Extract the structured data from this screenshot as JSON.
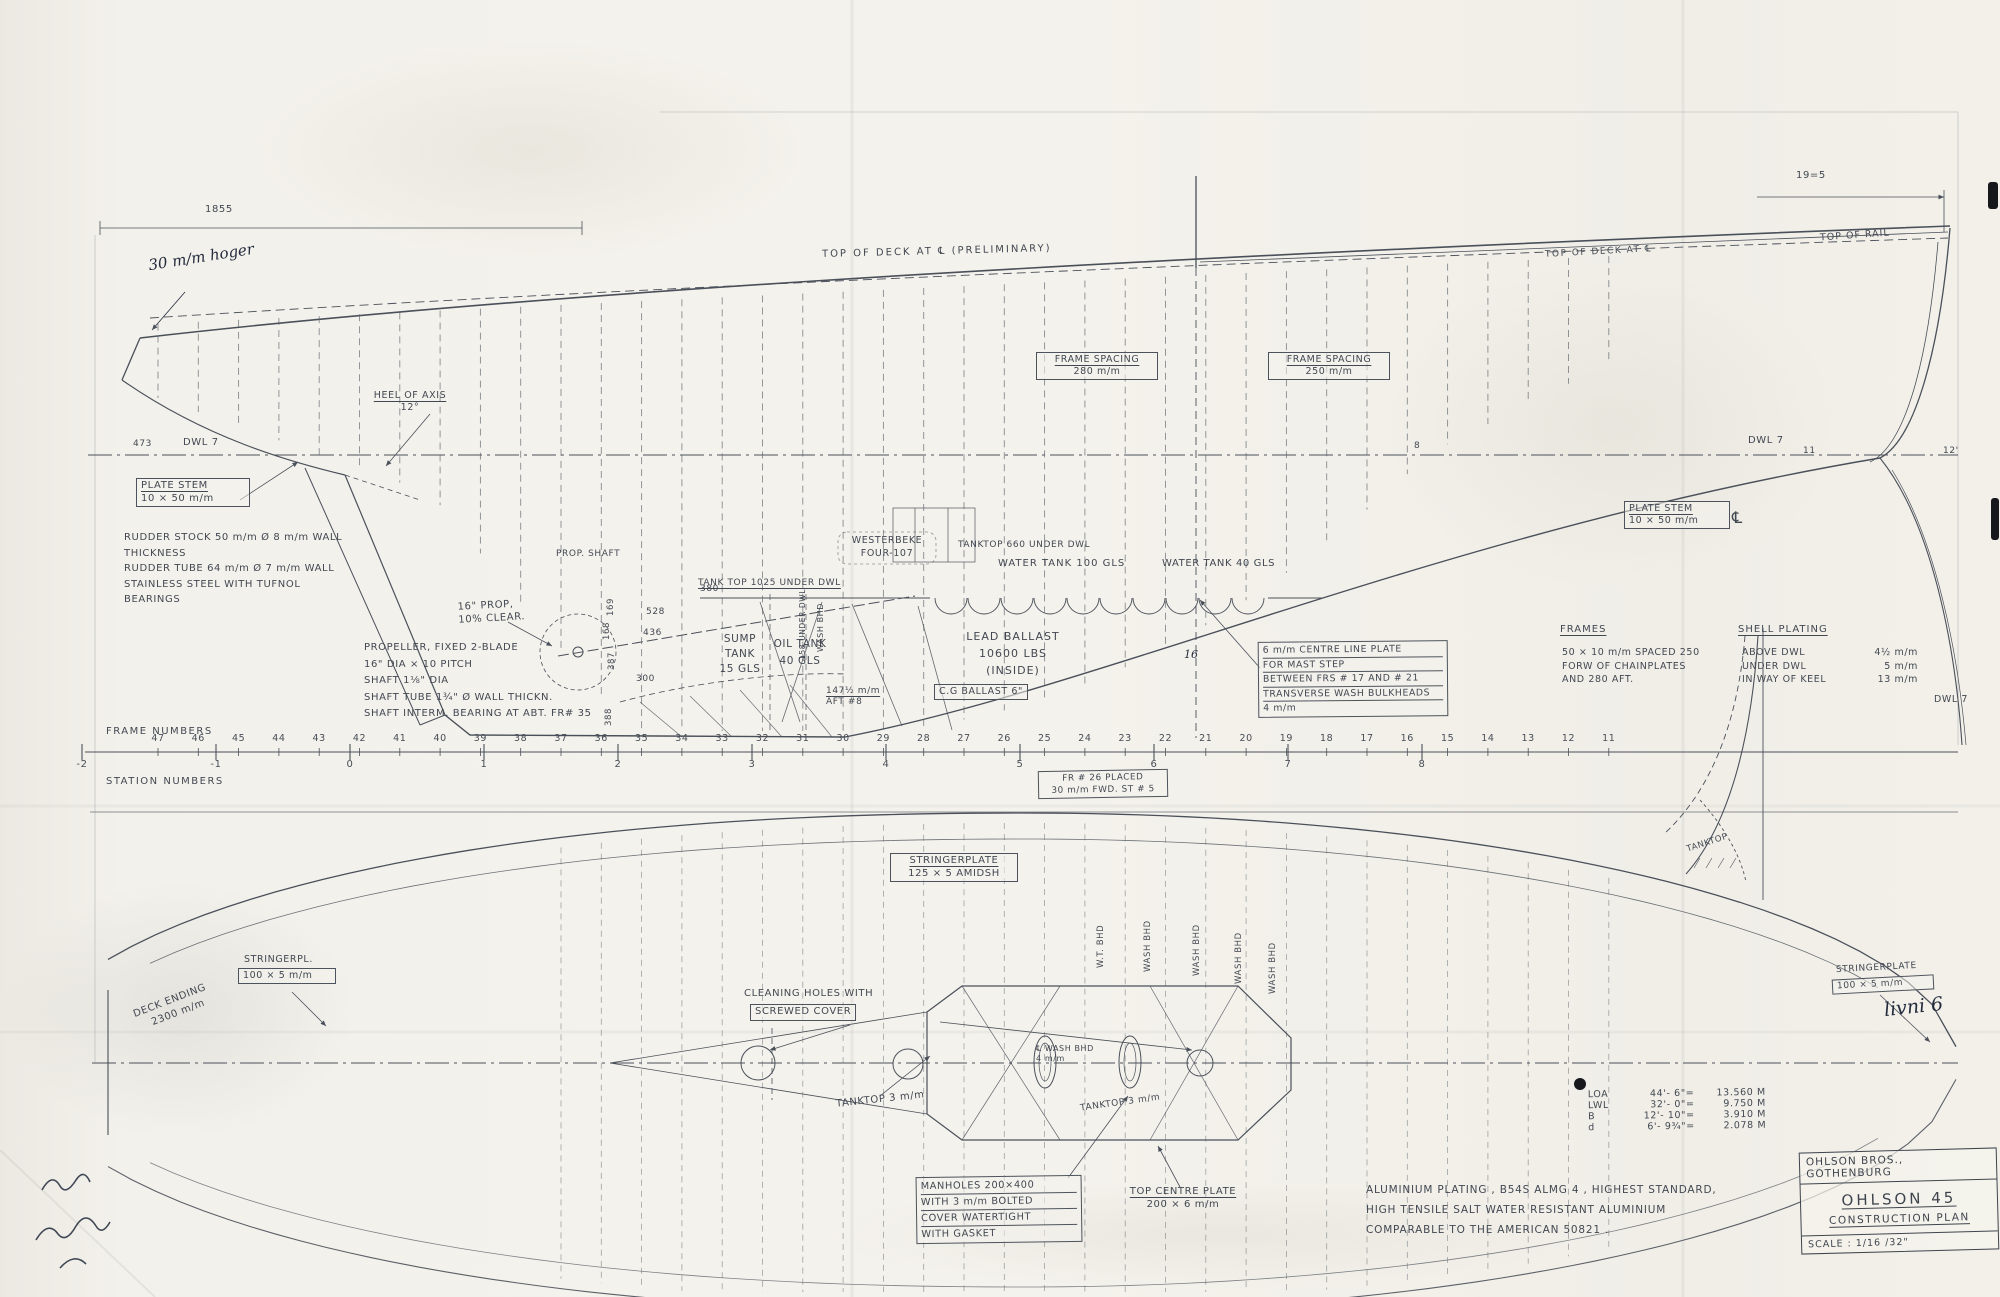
{
  "colors": {
    "paper": "#f3f1eb",
    "pencil": "#4a505a",
    "ink": "#222a3c"
  },
  "title_block": {
    "company": "OHLSON BROS., GOTHENBURG",
    "boat_name": "OHLSON 45",
    "drawing_name": "CONSTRUCTION PLAN",
    "scale": "SCALE : 1/16 /32\""
  },
  "material_note": {
    "l1": "ALUMINIUM PLATING , B54S ALMG 4 , HIGHEST STANDARD,",
    "l2": "HIGH TENSILE SALT WATER RESISTANT ALUMINIUM",
    "l3": "COMPARABLE TO THE AMERICAN 50821 ."
  },
  "principal_dimensions": {
    "rows": [
      {
        "label": "LOA",
        "feet": "44'- 6\"",
        "eq": "=",
        "metric": "13.560 M"
      },
      {
        "label": "LWL",
        "feet": "32'- 0\"",
        "eq": "=",
        "metric": "9.750 M"
      },
      {
        "label": "B",
        "feet": "12'- 10\"",
        "eq": "=",
        "metric": "3.910 M"
      },
      {
        "label": "d",
        "feet": "6'- 9¾\"",
        "eq": "=",
        "metric": "2.078 M"
      }
    ]
  },
  "ruler": {
    "frames_title": "FRAME NUMBERS",
    "stations_title": "STATION NUMBERS",
    "frame_numbers": [
      47,
      46,
      45,
      44,
      43,
      42,
      41,
      40,
      39,
      38,
      37,
      36,
      35,
      34,
      33,
      32,
      31,
      30,
      29,
      28,
      27,
      26,
      25,
      24,
      23,
      22,
      21,
      20,
      19,
      18,
      17,
      16,
      15,
      14,
      13,
      12,
      11
    ],
    "station_numbers": [
      "-2",
      "-1",
      "0",
      "1",
      "2",
      "3",
      "4",
      "5",
      "6",
      "7",
      "8"
    ],
    "fr26_note": {
      "l1": "FR # 26 PLACED",
      "l2": "30 m/m FWD. ST # 5"
    }
  },
  "labels": {
    "profile": {
      "dim_1855": "1855",
      "hoger_note": "30 m/m hoger",
      "top_of_deck": "TOP OF DECK AT ℄ (PRELIMINARY)",
      "top_of_deck_right": "TOP OF DECK AT ℄",
      "frame_spacing_fwd": {
        "l1": "FRAME SPACING",
        "l2": "280 m/m"
      },
      "frame_spacing_aft": {
        "l1": "FRAME SPACING",
        "l2": "250 m/m"
      },
      "dim_19_5": "19=5",
      "top_of_rail": "TOP OF RAIL",
      "wl_dim_473": "473",
      "dwl_left": "DWL 7",
      "dwl_right": "DWL 7",
      "dwl_right_lower": "DWL 7",
      "wl_mark_8": "8",
      "wl_mark_11": "11",
      "wl_mark_12": "12'",
      "heel_of_axis": {
        "l1": "HEEL OF AXIS",
        "l2": "12°"
      },
      "plate_stem_left": {
        "l1": "PLATE STEM",
        "l2": "10 × 50 m/m"
      },
      "plate_stem_right": {
        "l1": "PLATE STEM",
        "l2": "10 × 50 m/m"
      },
      "centerline_symbol": "℄",
      "rudder_note": {
        "l1": "RUDDER STOCK 50 m/m Ø 8 m/m WALL",
        "l2": "THICKNESS",
        "l3": "RUDDER TUBE 64 m/m Ø 7 m/m WALL",
        "l4": "STAINLESS STEEL WITH TUFNOL",
        "l5": "BEARINGS"
      },
      "prop_clear": {
        "l1": "16\" PROP,",
        "l2": "10% CLEAR."
      },
      "prop_note": {
        "l1": "PROPELLER, FIXED 2-BLADE",
        "l2": "16\" DIA × 10 PITCH",
        "l3": "SHAFT 1⅛\" DIA",
        "l4": "SHAFT TUBE 1¾\" Ø WALL THICKN.",
        "l5": "SHAFT INTERM. BEARING AT ABT. FR# 35"
      },
      "prop_shaft": "PROP. SHAFT",
      "tank_top_1025": "TANK TOP 1025 UNDER DWL",
      "sump_tank": {
        "l1": "SUMP",
        "l2": "TANK",
        "l3": "15 GLS"
      },
      "oil_tank": {
        "l1": "OIL TANK",
        "l2": "40 GLS"
      },
      "engine": {
        "l1": "WESTERBEKE",
        "l2": "FOUR-107"
      },
      "tanktop_660": "TANKTOP 660 UNDER DWL",
      "water_tank_100": "WATER TANK   100 GLS",
      "water_tank_40": "WATER TANK 40 GLS",
      "wash_bhd_vertical": "WASH BHD",
      "under_dwl_vertical": "158 UNDER DWL",
      "offsets": {
        "d1": "380",
        "d2": "528",
        "d3": "436",
        "d4": "300",
        "s1": "169",
        "s2": "168",
        "s3": "387",
        "s4": "388"
      },
      "aft_note": {
        "l1": "147½ m/m",
        "l2": "AFT #8"
      },
      "lead_ballast": {
        "l1": "LEAD BALLAST",
        "l2": "10600 LBS",
        "l3": "(INSIDE)"
      },
      "cg_ballast": "C.G BALLAST  6\"",
      "mast_step_box": {
        "l1": "6 m/m CENTRE LINE PLATE",
        "l2": "FOR MAST STEP",
        "l3": "BETWEEN FRS # 17 AND # 21",
        "l4": "TRANSVERSE WASH BULKHEADS",
        "l5": "4 m/m"
      },
      "frames_note": {
        "h": "FRAMES",
        "l1": "50 × 10 m/m SPACED 250",
        "l2": "FORW OF CHAINPLATES",
        "l3": "AND 280 AFT."
      },
      "shell_plating": {
        "h": "SHELL PLATING",
        "r1l": "ABOVE DWL",
        "r1v": "4½ m/m",
        "r2l": "UNDER DWL",
        "r2v": "5 m/m",
        "r3l": "IN WAY OF KEEL",
        "r3v": "13 m/m"
      },
      "pencil_16": "16"
    },
    "plan": {
      "stringerpl_left": {
        "l1": "STRINGERPL.",
        "l2": "100 × 5 m/m"
      },
      "deck_ending": {
        "l1": "DECK ENDING",
        "l2": "2300 m/m"
      },
      "stringerplate_mid": {
        "l1": "STRINGERPLATE",
        "l2": "125 × 5 AMIDSH"
      },
      "bhd_labels": [
        "W.T. BHD",
        "WASH BHD",
        "WASH BHD",
        "WASH BHD",
        "WASH BHD"
      ],
      "cleaning_holes": {
        "l1": "CLEANING HOLES WITH",
        "l2": "SCREWED COVER"
      },
      "tanktop_3_left": "TANKTOP 3 m/m",
      "wash_bhd_4": {
        "l1": "℄ WASH BHD",
        "l2": "4 m/m"
      },
      "tanktop_3_right": "TANKTOP 3 m/m",
      "manholes": {
        "l1": "MANHOLES 200×400",
        "l2": "WITH 3 m/m BOLTED",
        "l3": "COVER WATERTIGHT",
        "l4": "WITH GASKET"
      },
      "top_centre_plate": {
        "l1": "TOP CENTRE PLATE",
        "l2": "200 × 6 m/m"
      },
      "stringerplate_right": {
        "l1": "STRINGERPLATE",
        "l2": "100 × 5 m/m"
      },
      "handwritten_note": "livni 6",
      "tanktop_detail": "TANKTOP"
    }
  }
}
